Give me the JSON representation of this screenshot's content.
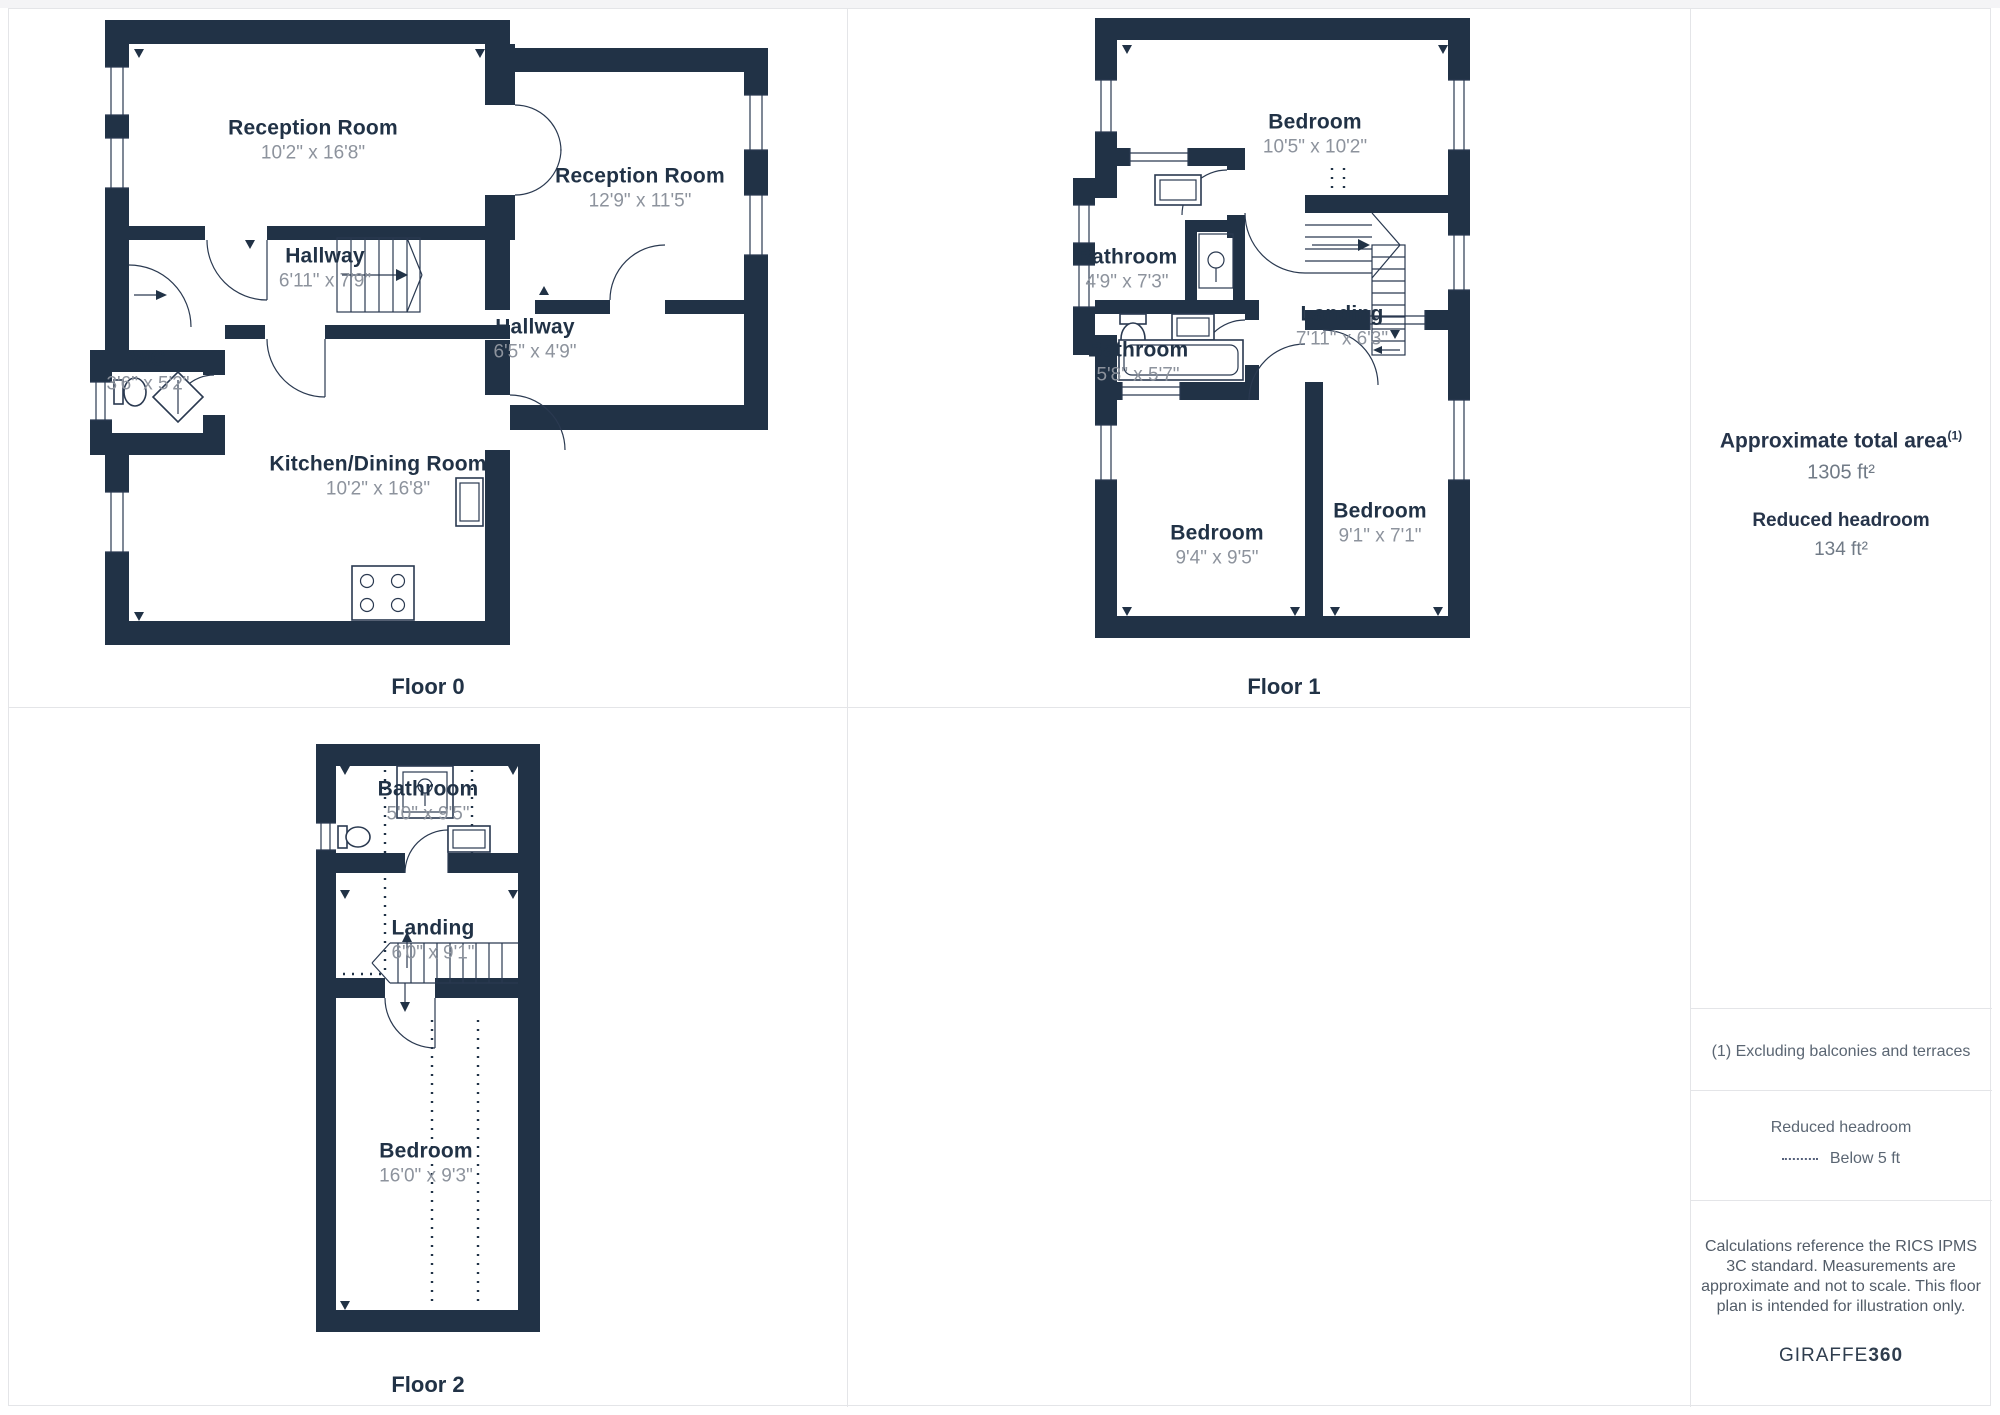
{
  "floors": [
    {
      "label": "Floor 0",
      "rooms": [
        {
          "name": "Reception Room",
          "dims": "10'2\" x 16'8\""
        },
        {
          "name": "Reception Room",
          "dims": "12'9\" x 11'5\""
        },
        {
          "name": "Hallway",
          "dims": "6'11\" x 7'9\""
        },
        {
          "name": "WC",
          "dims": "3'6\" x 5'2\""
        },
        {
          "name": "Hallway",
          "dims": "6'5\" x 4'9\""
        },
        {
          "name": "Kitchen/Dining Room",
          "dims": "10'2\" x 16'8\""
        }
      ]
    },
    {
      "label": "Floor 1",
      "rooms": [
        {
          "name": "Bedroom",
          "dims": "10'5\" x 10'2\""
        },
        {
          "name": "Bathroom",
          "dims": "4'9\" x 7'3\""
        },
        {
          "name": "Bathroom",
          "dims": "5'8\" x 5'7\""
        },
        {
          "name": "Landing",
          "dims": "7'11\" x 6'3\""
        },
        {
          "name": "Bedroom",
          "dims": "9'4\" x 9'5\""
        },
        {
          "name": "Bedroom",
          "dims": "9'1\" x 7'1\""
        }
      ]
    },
    {
      "label": "Floor 2",
      "rooms": [
        {
          "name": "Bathroom",
          "dims": "5'0\" x 9'5\""
        },
        {
          "name": "Landing",
          "dims": "6'0\" x 9'1\""
        },
        {
          "name": "Bedroom",
          "dims": "16'0\" x 9'3\""
        }
      ]
    }
  ],
  "sidebar": {
    "total_area_title": "Approximate total area",
    "total_area_footnote_marker": "(1)",
    "total_area_value": "1305 ft²",
    "reduced_headroom_label": "Reduced headroom",
    "reduced_headroom_value": "134 ft²",
    "footnote": "(1) Excluding balconies and terraces",
    "legend_title": "Reduced headroom",
    "legend_item": "Below 5 ft",
    "disclaimer": "Calculations reference the RICS IPMS 3C standard. Measurements are approximate and not to scale. This floor plan is intended for illustration only.",
    "brand_name": "GIRAFFE",
    "brand_suffix": "360"
  }
}
